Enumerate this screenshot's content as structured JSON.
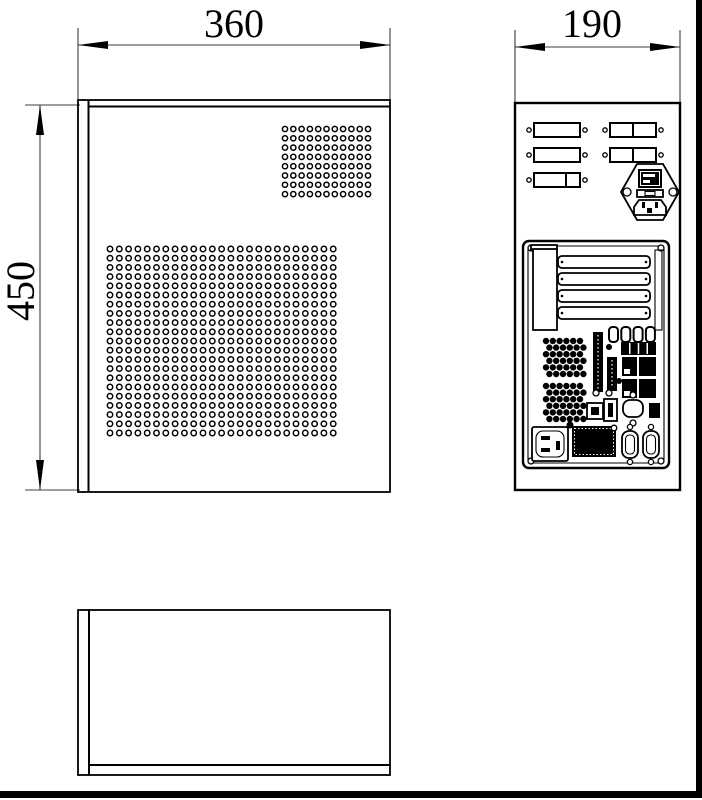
{
  "colors": {
    "background": "#ffffff",
    "object_line": "#000000",
    "dimension_line": "#3c3c3c",
    "frame": "#000000"
  },
  "dimensions": {
    "side_width_mm": "360",
    "rear_width_mm": "190",
    "side_height_mm": "450"
  },
  "side_view": {
    "small_vent_grid": {
      "cols": 11,
      "rows": 8,
      "x": 285,
      "y": 129,
      "dx": 8.3,
      "dy": 9.3,
      "r": 2.6
    },
    "large_vent_grid": {
      "cols": 25,
      "rows": 21,
      "x": 110,
      "y": 249,
      "dx": 9.3,
      "dy": 9.2,
      "r": 2.7
    }
  },
  "rear_view": {
    "io_cutouts_left": {
      "x": 534,
      "w": 46,
      "h": 14,
      "ys": [
        123,
        148,
        173
      ],
      "dividers": [
        -1,
        -1,
        32
      ]
    },
    "io_cutouts_right": {
      "x": 610,
      "w": 46,
      "h": 14,
      "ys": [
        123,
        148
      ],
      "dividers": [
        23,
        23
      ]
    },
    "expansion_slots": {
      "x": 558,
      "w": 92,
      "h": 12,
      "ys": [
        256,
        273,
        290,
        307
      ]
    },
    "audio_jacks": {
      "count": 4,
      "x": 609,
      "y": 327,
      "dx": 12.3,
      "w": 9,
      "h": 15
    },
    "vent_grille": {
      "x": 621,
      "y": 342,
      "w": 35,
      "h": 13,
      "segments": 4
    },
    "fan_grille_top": {
      "cols": 6,
      "rows": 6,
      "x": 546,
      "y": 341,
      "dx": 6.8,
      "dy": 6.6,
      "r": 3.2,
      "stagger": 3.4
    },
    "fan_grille_bottom": {
      "cols": 6,
      "rows": 6,
      "x": 546,
      "y": 386,
      "dx": 6.8,
      "dy": 6.6,
      "r": 3.2,
      "stagger": 3.4
    }
  }
}
